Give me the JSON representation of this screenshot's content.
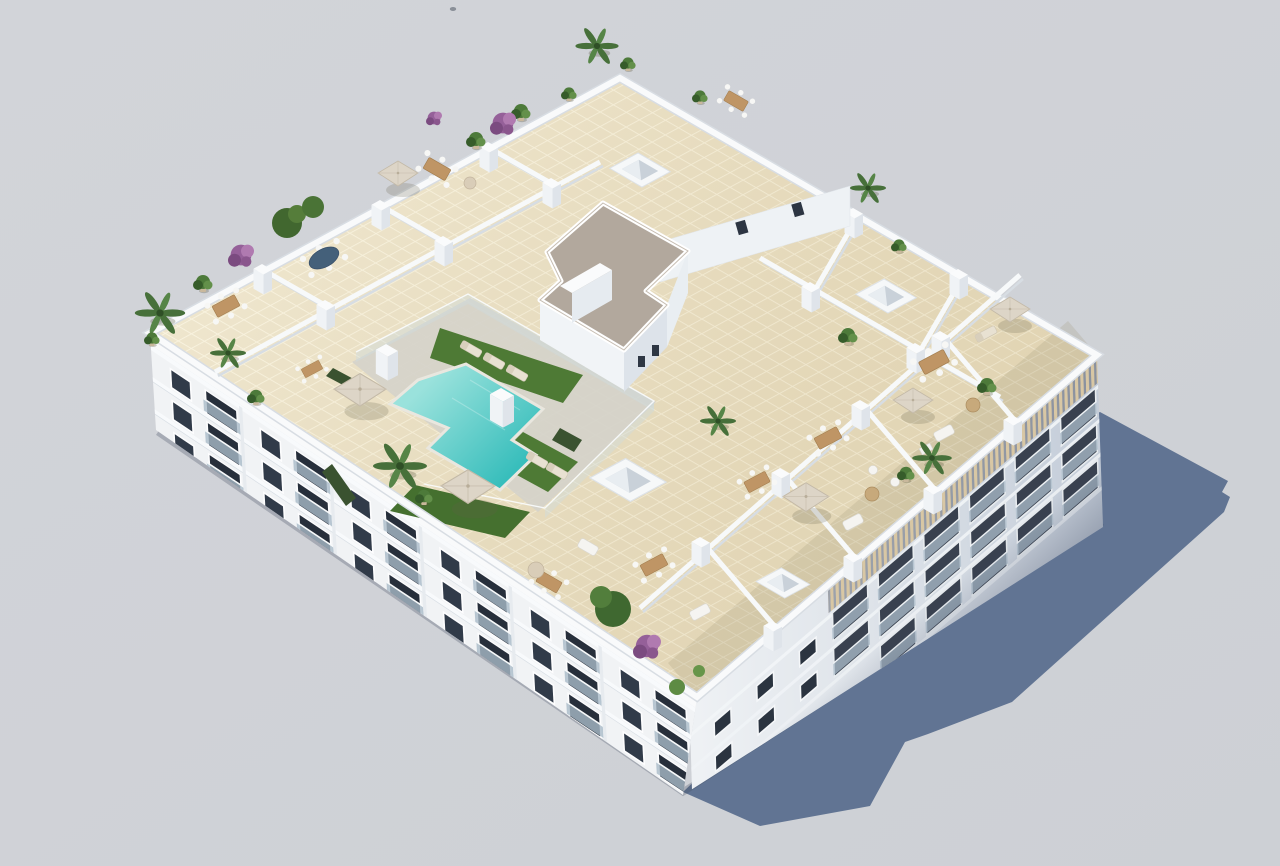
{
  "meta": {
    "type": "3d-architectural-render",
    "alt": "Aerial isometric 3D render of a white apartment building rooftop: communal turquoise T-shaped pool with glass fencing, artificial grass with sun loungers, beige tiled deck, private roof terraces with parasols, wooden dining sets, white sofas, palms and bougainvillea, a gravel-roofed service core, wooden louver pergola on the right edge, long blue-grey shadow cast on a plain light grey ground, small bird overhead."
  },
  "palette": {
    "bg": "#d2d4d9",
    "bg2": "#cdd0d5",
    "shadow": "#5d7090",
    "tile": "#e9dec1",
    "tileline": "#f7f0da",
    "deck": "#d5d2ca",
    "parapet": "#f9fafb",
    "wallshade": "#d7dde3",
    "gravel": "#b2a89d",
    "pooldeep": "#35bdbb",
    "poollight": "#9ae2dc",
    "grass": "#4e7a35",
    "hedge": "#3a5230",
    "plant": "#4d7a3a",
    "purple": "#956099",
    "wood": "#bf9565",
    "umbrella": "#ddd5c7",
    "glass": "#313b49",
    "balcony": "#a9bac8",
    "louver": "#d8c7a4",
    "facadelight": "#eef1f4",
    "facadedark": "#c3ccd8"
  },
  "scene": {
    "camera": "aerial-isometric-from-southwest",
    "ground": "plain light grey",
    "building": {
      "shape": "rectangular block",
      "floors_visible": 3,
      "facades_visible": [
        "southwest with balconies",
        "southeast with louver pergola and balconies"
      ],
      "roof": "communal pool terrace + private terraces"
    },
    "inventory": {
      "pools": 1,
      "pool_shape": "T-shaped",
      "parasols": 6,
      "skylight_boxes": 4,
      "sun_loungers": 6,
      "dining_sets": 10,
      "white_sofas": 4,
      "palm_trees": 7,
      "potted_plants": 15,
      "bougainvillea_shrubs": 4,
      "grass_patches": 3,
      "hedges": 3,
      "private_terraces": 12,
      "pergola_louver_bands": 1,
      "service_cores": 1,
      "birds": 1
    }
  }
}
